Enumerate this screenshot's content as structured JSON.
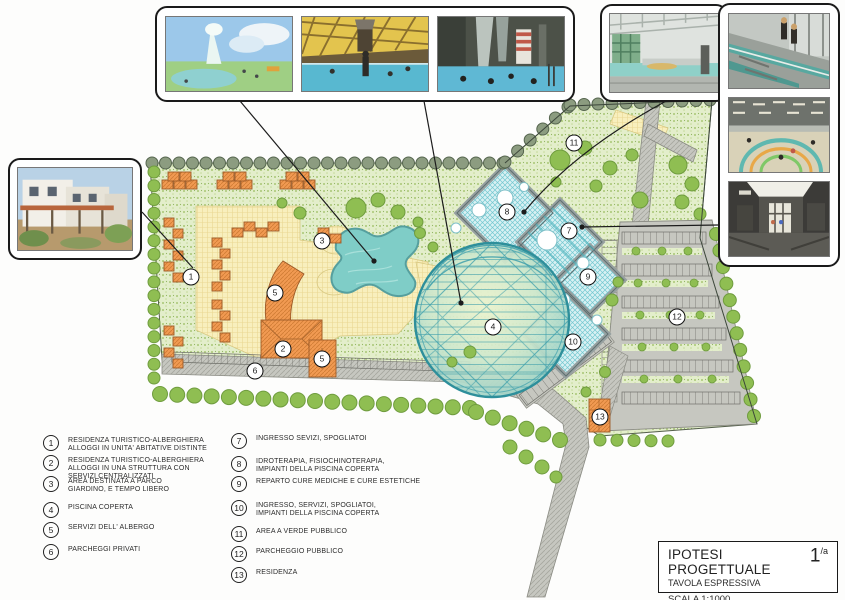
{
  "palette": {
    "paper": "#fdfdfc",
    "ground-green": "#e3eecb",
    "speckle-green": "#a9c775",
    "tree-green": "#8fbe52",
    "tree-dark": "#6f9c3e",
    "border-tree": "#8c9c80",
    "orange-building": "#f19a52",
    "orange-line": "#d07c34",
    "deck-yellow": "#f8efbd",
    "water-teal": "#7fcdc7",
    "dome-grid": "#3fa0ac",
    "blue-building": "#d9f1f3",
    "blue-cross": "#74c8d0",
    "road-gray": "#c6c7c0",
    "ink": "#1c1c1c"
  },
  "photo_panels": {
    "left": {
      "photos": [
        "residence-building-exterior"
      ]
    },
    "top": {
      "photos": [
        "outdoor-pool-with-fountain",
        "indoor-pool-yellow-roof",
        "indoor-pool-waterfall"
      ]
    },
    "top_right": {
      "photos": [
        "indoor-pool-hall-green-windows"
      ]
    },
    "right": {
      "photos": [
        "indoor-pool-deck-divers",
        "indoor-pool-teaching-circle",
        "entrance-lobby-interior"
      ]
    }
  },
  "plan": {
    "markers": [
      {
        "label": "1",
        "x": 191,
        "y": 277
      },
      {
        "label": "2",
        "x": 283,
        "y": 349
      },
      {
        "label": "3",
        "x": 322,
        "y": 241
      },
      {
        "label": "4",
        "x": 493,
        "y": 327
      },
      {
        "label": "5",
        "x": 275,
        "y": 293
      },
      {
        "label": "5",
        "x": 322,
        "y": 359
      },
      {
        "label": "6",
        "x": 255,
        "y": 371
      },
      {
        "label": "7",
        "x": 569,
        "y": 231
      },
      {
        "label": "8",
        "x": 507,
        "y": 212
      },
      {
        "label": "9",
        "x": 588,
        "y": 277
      },
      {
        "label": "10",
        "x": 573,
        "y": 342
      },
      {
        "label": "11",
        "x": 574,
        "y": 143
      },
      {
        "label": "12",
        "x": 677,
        "y": 317
      },
      {
        "label": "13",
        "x": 600,
        "y": 417
      }
    ]
  },
  "legend": {
    "items": [
      {
        "num": "1",
        "col": 1,
        "top": 435,
        "text": "RESIDENZA TURISTICO-ALBERGHIERA\nALLOGGI IN UNITA' ABITATIVE DISTINTE"
      },
      {
        "num": "2",
        "col": 1,
        "top": 455,
        "text": "RESIDENZA TURISTICO-ALBERGHIERA\nALLOGGI IN UNA STRUTTURA CON\nSERVIZI CENTRALIZZATI"
      },
      {
        "num": "3",
        "col": 1,
        "top": 476,
        "text": "AREA DESTINATA A PARCO\nGIARDINO, E TEMPO LIBERO"
      },
      {
        "num": "4",
        "col": 1,
        "top": 502,
        "text": "PISCINA COPERTA"
      },
      {
        "num": "5",
        "col": 1,
        "top": 522,
        "text": "SERVIZI DELL' ALBERGO"
      },
      {
        "num": "6",
        "col": 1,
        "top": 544,
        "text": "PARCHEGGI PRIVATI"
      },
      {
        "num": "7",
        "col": 2,
        "top": 433,
        "text": "INGRESSO SEVIZI, SPOGLIATOI"
      },
      {
        "num": "8",
        "col": 2,
        "top": 456,
        "text": "IDROTERAPIA, FISIOCHINOTERAPIA,\nIMPIANTI DELLA PISCINA COPERTA"
      },
      {
        "num": "9",
        "col": 2,
        "top": 476,
        "text": "REPARTO CURE MEDICHE E CURE ESTETICHE"
      },
      {
        "num": "10",
        "col": 2,
        "top": 500,
        "text": "INGRESSO, SERVIZI, SPOGLIATOI,\nIMPIANTI DELLA PISCINA COPERTA"
      },
      {
        "num": "11",
        "col": 2,
        "top": 526,
        "text": "AREA A VERDE PUBBLICO"
      },
      {
        "num": "12",
        "col": 2,
        "top": 546,
        "text": "PARCHEGGIO PUBBLICO"
      },
      {
        "num": "13",
        "col": 2,
        "top": 567,
        "text": "RESIDENZA"
      }
    ]
  },
  "title_block": {
    "title": "IPOTESI PROGETTUALE",
    "sheet_number": "1",
    "sheet_suffix": "/a",
    "subtitle": "TAVOLA ESPRESSIVA",
    "scale": "SCALA 1:1000"
  }
}
